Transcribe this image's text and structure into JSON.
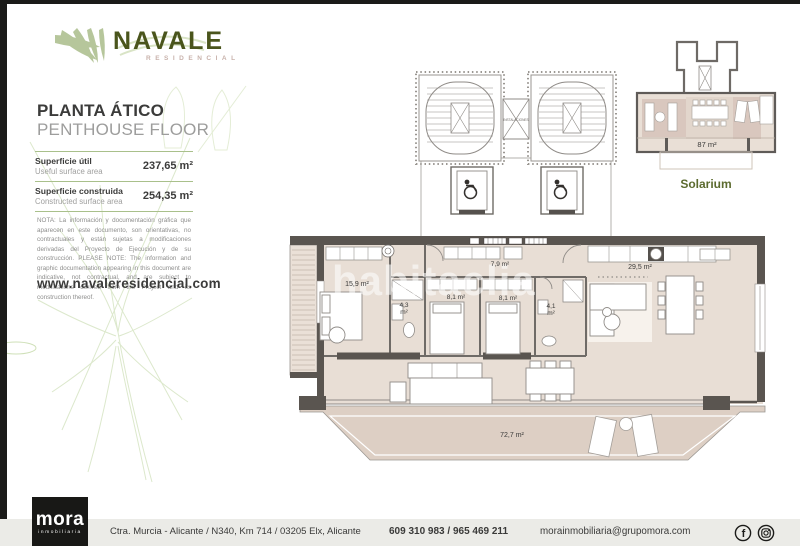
{
  "brand": {
    "name": "NAVALE",
    "tagline": "RESIDENCIAL"
  },
  "page": {
    "title_es": "PLANTA ÁTICO",
    "title_en": "PENTHOUSE FLOOR",
    "website": "www.navaleresidencial.com"
  },
  "surface": {
    "rows": [
      {
        "label_es": "Superficie útil",
        "label_en": "Useful surface area",
        "value": "237,65 m²"
      },
      {
        "label_es": "Superficie construida",
        "label_en": "Constructed surface area",
        "value": "254,35 m²"
      }
    ]
  },
  "note": "NOTA: La información y documentación gráfica que aparecen en este documento, son orientativas, no contractuales y están sujetas a modificaciones derivadas del Proyecto de Ejecución y de su construcción. PLEASE NOTE: The information and graphic documentation appearing in this document are indicative, not contractual, and are subject to modifications derived from the Project and its construction thereof.",
  "plan": {
    "watermark": "habitaclia",
    "installations_label": "INSTALACIONES",
    "rooms": {
      "bedroom1": "15,9 m²",
      "bath1_value": "4,3",
      "bath1_unit": "m²",
      "bedroom2": "8,1 m²",
      "bedroom3": "8,1 m²",
      "hallway": "7,9 m²",
      "bath2_value": "4,1",
      "bath2_unit": "m²",
      "living": "29,5 m²",
      "terrace": "72,7 m²"
    }
  },
  "solarium": {
    "label": "Solarium",
    "area": "87 m²"
  },
  "footer": {
    "logo": "mora",
    "logo_sub": "inmobiliaria",
    "address": "Ctra. Murcia - Alicante / N340, Km 714 / 03205 Elx, Alicante",
    "phones": "609 310 983 / 965 469 211",
    "email": "morainmobiliaria@grupomora.com",
    "social": [
      "facebook",
      "instagram"
    ]
  },
  "colors": {
    "brand_green": "#4a551c",
    "sage": "#b6c69b",
    "residencial_pink": "#c8b2ab",
    "divider_green": "#a9c08b",
    "wall_gray": "#5a5550",
    "floor_beige": "#e8ded5",
    "terrace_beige": "#ddcfc4",
    "rug_mauve": "#d9c7be",
    "footer_bar": "#ebebe7",
    "solarium_label_green": "#5c6b2f"
  }
}
